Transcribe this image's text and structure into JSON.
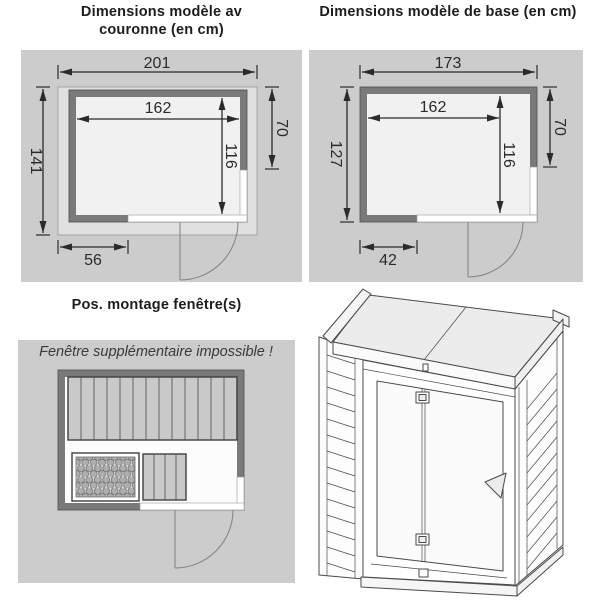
{
  "colors": {
    "panel_bg": "#cccccc",
    "wall": "#7a7a7a",
    "floor": "#f1f1f1",
    "bench": "#c9c9c9",
    "crown_band": "#e0e0e0",
    "dim_line": "#2b2b2b"
  },
  "top_left": {
    "title_line1": "Dimensions modèle av",
    "title_line2": "couronne (en cm)",
    "dims": {
      "outer_width": "201",
      "outer_depth": "141",
      "inner_width": "162",
      "inner_depth": "116",
      "side_window_offset": "70",
      "front_wall_segment": "56"
    }
  },
  "top_right": {
    "title": "Dimensions modèle de base (en cm)",
    "dims": {
      "outer_width": "173",
      "outer_depth": "127",
      "inner_width": "162",
      "inner_depth": "116",
      "side_window_offset": "70",
      "front_wall_segment": "42"
    }
  },
  "window_positions": {
    "title": "Pos. montage fenêtre(s)",
    "note": "Fenêtre supplémentaire impossible !"
  }
}
